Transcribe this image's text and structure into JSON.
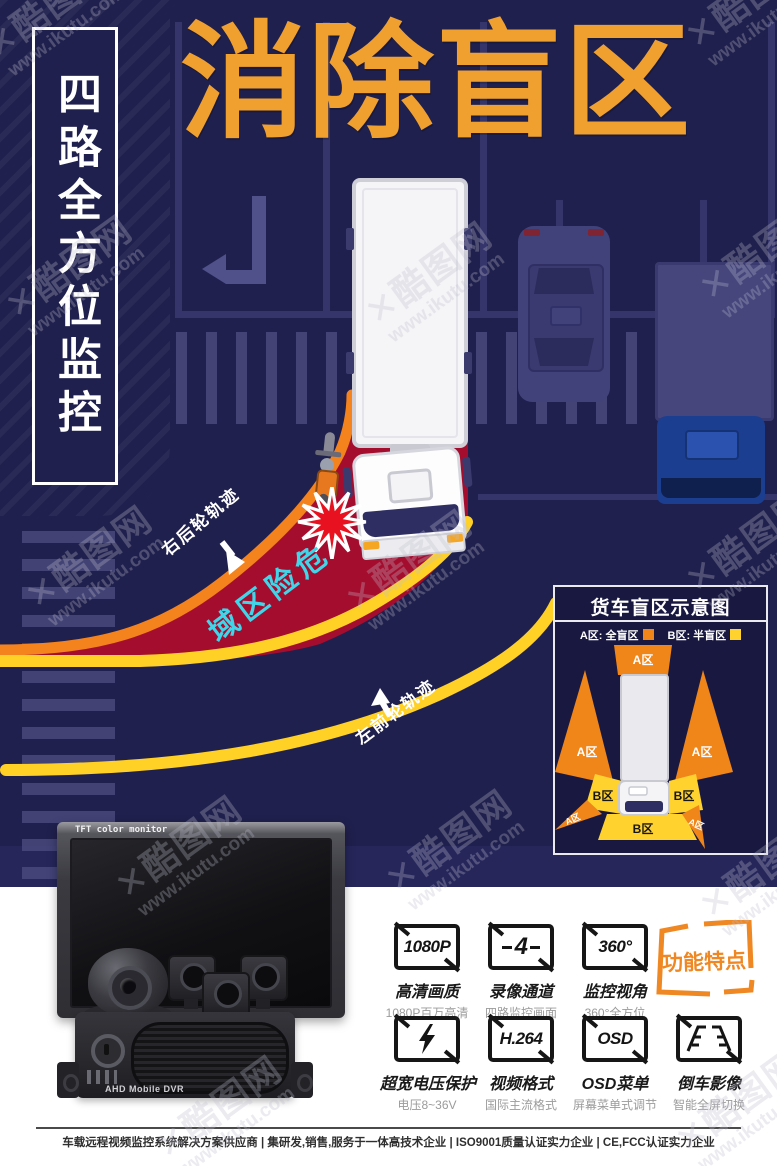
{
  "watermark": {
    "mark": "✕",
    "brand": "酷图网",
    "url": "www.ikutu.com"
  },
  "banner": {
    "text": "四路全方位监控"
  },
  "title": "消除盲区",
  "scene": {
    "right_rear_label": "右后轮轨迹",
    "left_front_label": "左前轮轨迹",
    "danger_label": "危险区域",
    "colors": {
      "background": "#20204e",
      "title_orange": "#f0a02f",
      "track_orange": "#f5831d",
      "track_yellow": "#ffd127",
      "danger_red": "#a50d2f",
      "danger_text_cyan": "#3fd6ea"
    }
  },
  "diagram": {
    "title": "货车盲区示意图",
    "legend": [
      {
        "label": "A区: 全盲区",
        "color": "#f08519"
      },
      {
        "label": "B区: 半盲区",
        "color": "#ffd22e"
      }
    ],
    "zones": {
      "top": "A区",
      "left": "A区",
      "right": "A区",
      "cab_left": "B区",
      "cab_right": "B区",
      "front": "B区",
      "wedge_left": "A区",
      "wedge_right": "A区"
    }
  },
  "products": {
    "monitor_label": "TFT color monitor",
    "dvr_label": "AHD Mobile DVR"
  },
  "features": {
    "badge": "功能特点",
    "items": [
      {
        "icon_text": "1080P",
        "title": "高清画质",
        "subtitle": "1080P百万高清"
      },
      {
        "icon_text": "4",
        "title": "录像通道",
        "subtitle": "四路监控画面"
      },
      {
        "icon_text": "360°",
        "title": "监控视角",
        "subtitle": "360°全方位"
      },
      {
        "icon": "lightning-icon",
        "title": "超宽电压保护",
        "subtitle": "电压8~36V"
      },
      {
        "icon_text": "H.264",
        "title": "视频格式",
        "subtitle": "国际主流格式"
      },
      {
        "icon_text": "OSD",
        "title": "OSD菜单",
        "subtitle": "屏幕菜单式调节"
      },
      {
        "icon": "reverse-camera-icon",
        "title": "倒车影像",
        "subtitle": "智能全屏切换"
      }
    ]
  },
  "footer": {
    "text": "车载远程视频监控系统解决方案供应商 | 集研发,销售,服务于一体高技术企业 | ISO9001质量认证实力企业 | CE,FCC认证实力企业"
  }
}
